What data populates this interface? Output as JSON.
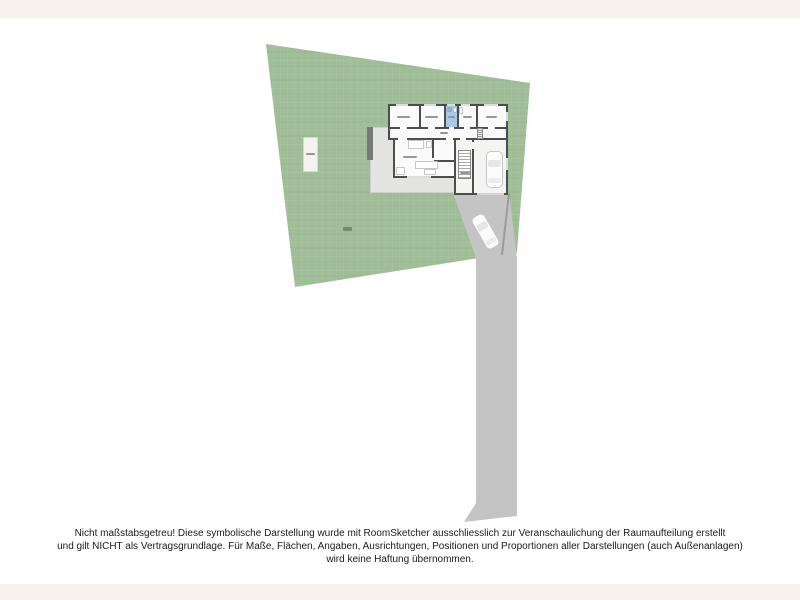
{
  "app": {
    "description": "RoomSketcher site plan rendering of a property plot with house floor plan, driveway and car"
  },
  "disclaimer": {
    "line1": "Nicht maßstabsgetreu! Diese symbolische Darstellung wurde mit RoomSketcher ausschliesslich zur Veranschaulichung der Raumaufteilung erstellt",
    "line2": "und gilt NICHT als Vertragsgrundlage. Für Maße, Flächen, Angaben, Ausrichtungen, Positionen und Proportionen aller Darstellungen (auch Außenanlagen)",
    "line3": "wird keine Haftung übernommen."
  },
  "site_plan": {
    "colors": {
      "page_background": "#F8F4EC",
      "canvas": "#FFFFFF",
      "grass": "#9FBE97",
      "driveway": "#C4C4C4",
      "patio": "#E3E3E2",
      "wall": "#4D4D4D",
      "floor": "#FAFAFA",
      "bathroom": "#A9C7E8"
    },
    "features": [
      "grass-plot",
      "house-floor-plan",
      "bathroom",
      "staircase",
      "garage-with-car",
      "patio-terrace",
      "driveway-with-car",
      "parking-pad"
    ]
  }
}
